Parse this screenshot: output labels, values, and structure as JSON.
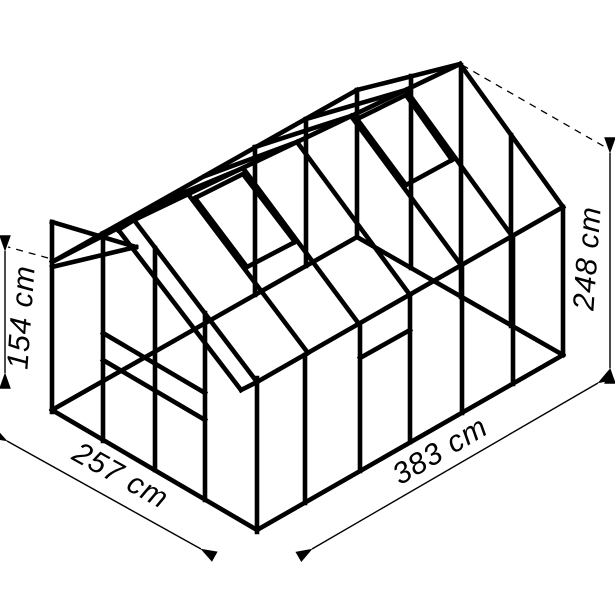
{
  "diagram": {
    "subject": "greenhouse-wireframe-dimension-drawing",
    "unit": "cm",
    "background_color": "#ffffff",
    "line_color": "#000000",
    "dimensions": {
      "side_wall_height": {
        "label": "154 cm",
        "value": 154,
        "orientation": "vertical-left"
      },
      "ridge_height": {
        "label": "248 cm",
        "value": 248,
        "orientation": "vertical-right"
      },
      "front_width": {
        "label": "257 cm",
        "value": 257,
        "orientation": "diagonal-front"
      },
      "side_length": {
        "label": "383 cm",
        "value": 383,
        "orientation": "diagonal-side"
      }
    }
  }
}
